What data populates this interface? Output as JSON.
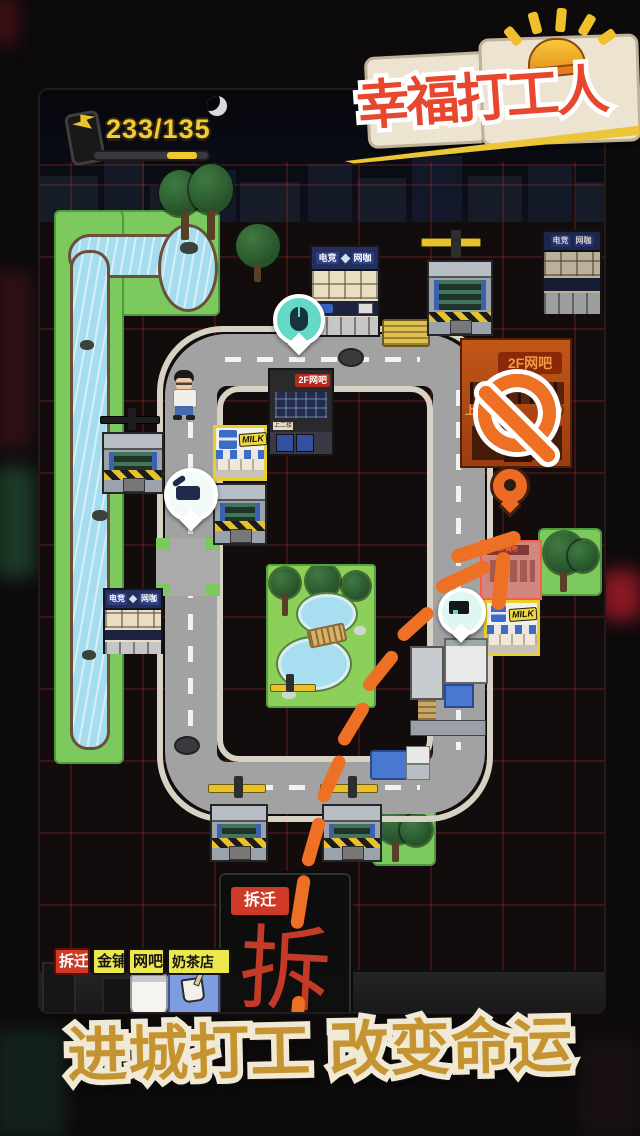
{
  "app": {
    "logo_title": "幸福打工人",
    "tagline": "进城打工 改变命运"
  },
  "hud": {
    "energy": "233/135"
  },
  "map": {
    "signs": {
      "esports_left": "电竞",
      "esports_right": "网咖",
      "netbar_2f": "2F网吧",
      "upstairs": "上二楼",
      "up": "上",
      "milk": "MILK"
    },
    "pins": {
      "mouse": "computer-mouse-icon",
      "excavator": "excavator-icon",
      "worksite": "worksite-icon",
      "destination": "location-pin-icon"
    },
    "panel": {
      "label": "拆迁",
      "glyph": "拆"
    },
    "tags": {
      "demolition": "拆迁",
      "gold_shop": "金铺",
      "net_bar": "网吧",
      "milk_tea": "奶茶店"
    }
  }
}
